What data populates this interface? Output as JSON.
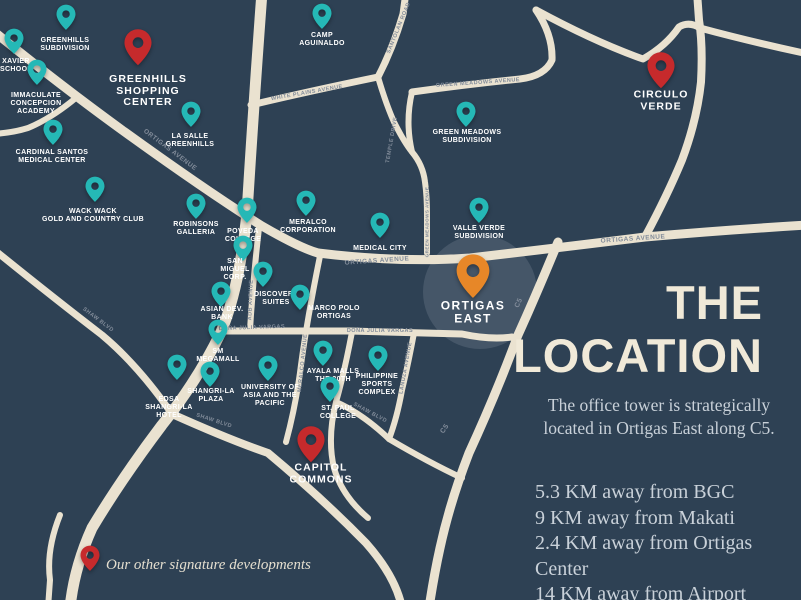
{
  "map": {
    "background_color": "#2e4154",
    "road_color": "#eae2d0",
    "pin_colors": {
      "teal": "#25b8b6",
      "red": "#c62a2c",
      "orange": "#e78728"
    },
    "highlight": {
      "x": 480,
      "y": 292,
      "r": 57
    },
    "pins": [
      {
        "id": "greenhills-subdivision",
        "type": "teal",
        "x": 66,
        "y": 20,
        "label": "GREENHILLS\nSUBDIVISION",
        "lx": 65,
        "ly": 45
      },
      {
        "id": "xavier-school",
        "type": "teal",
        "x": 14,
        "y": 44,
        "label": "XAVIER\nSCHOOL",
        "lx": 16,
        "ly": 66
      },
      {
        "id": "immaculate-concepcion-academy",
        "type": "teal",
        "x": 37,
        "y": 75,
        "label": "IMMACULATE\nCONCEPCION\nACADEMY",
        "lx": 36,
        "ly": 104
      },
      {
        "id": "cardinal-santos-medical-center",
        "type": "teal",
        "x": 53,
        "y": 135,
        "label": "CARDINAL SANTOS\nMEDICAL CENTER",
        "lx": 52,
        "ly": 157
      },
      {
        "id": "la-salle-greenhills",
        "type": "teal",
        "x": 191,
        "y": 117,
        "label": "LA SALLE\nGREENHILLS",
        "lx": 190,
        "ly": 141
      },
      {
        "id": "camp-aguinaldo",
        "type": "teal",
        "x": 322,
        "y": 19,
        "label": "CAMP\nAGUINALDO",
        "lx": 322,
        "ly": 40
      },
      {
        "id": "green-meadows-subdivision",
        "type": "teal",
        "x": 466,
        "y": 117,
        "label": "GREEN MEADOWS\nSUBDIVISION",
        "lx": 467,
        "ly": 137
      },
      {
        "id": "wack-wack-golf",
        "type": "teal",
        "x": 95,
        "y": 192,
        "label": "WACK WACK\nGOLD AND COUNTRY CLUB",
        "lx": 93,
        "ly": 216
      },
      {
        "id": "robinsons-galleria",
        "type": "teal",
        "x": 196,
        "y": 209,
        "label": "ROBINSONS\nGALLERIA",
        "lx": 196,
        "ly": 229
      },
      {
        "id": "poveda-college",
        "type": "teal",
        "x": 247,
        "y": 213,
        "label": "POVEDA\nCOLLEGE",
        "lx": 243,
        "ly": 236
      },
      {
        "id": "san-miguel-corp",
        "type": "teal",
        "x": 243,
        "y": 251,
        "label": "SAN\nMIGUEL\nCORP.",
        "lx": 235,
        "ly": 270
      },
      {
        "id": "discovery-suites",
        "type": "teal",
        "x": 263,
        "y": 277,
        "label": "DISCOVERY\nSUITES",
        "lx": 276,
        "ly": 299
      },
      {
        "id": "asian-dev-bank",
        "type": "teal",
        "x": 221,
        "y": 297,
        "label": "ASIAN DEV.\nBANK",
        "lx": 222,
        "ly": 314
      },
      {
        "id": "meralco-corporation",
        "type": "teal",
        "x": 306,
        "y": 206,
        "label": "MERALCO\nCORPORATION",
        "lx": 308,
        "ly": 227
      },
      {
        "id": "medical-city",
        "type": "teal",
        "x": 380,
        "y": 228,
        "label": "MEDICAL CITY",
        "lx": 380,
        "ly": 249
      },
      {
        "id": "valle-verde-subdivision",
        "type": "teal",
        "x": 479,
        "y": 213,
        "label": "VALLE VERDE\nSUBDIVISION",
        "lx": 479,
        "ly": 233
      },
      {
        "id": "marco-polo-ortigas",
        "type": "teal",
        "x": 300,
        "y": 300,
        "label": "MARCO POLO\nORTIGAS",
        "lx": 334,
        "ly": 313
      },
      {
        "id": "sm-megamall",
        "type": "teal",
        "x": 218,
        "y": 335,
        "label": "SM\nMEGAMALL",
        "lx": 218,
        "ly": 356
      },
      {
        "id": "shangri-la-plaza",
        "type": "teal",
        "x": 210,
        "y": 377,
        "label": "SHANGRI-LA\nPLAZA",
        "lx": 211,
        "ly": 396
      },
      {
        "id": "edsa-shangri-la-hotel",
        "type": "teal",
        "x": 177,
        "y": 370,
        "label": "EDSA\nSHANGRI-LA\nHOTEL",
        "lx": 169,
        "ly": 408
      },
      {
        "id": "university-asia-pacific",
        "type": "teal",
        "x": 268,
        "y": 371,
        "label": "UNIVERSITY OF\nASIA AND THE\nPACIFIC",
        "lx": 270,
        "ly": 396
      },
      {
        "id": "ayala-malls-30th",
        "type": "teal",
        "x": 323,
        "y": 356,
        "label": "AYALA MALLS\nTHE 30TH",
        "lx": 333,
        "ly": 376
      },
      {
        "id": "philippine-sports-complex",
        "type": "teal",
        "x": 378,
        "y": 361,
        "label": "PHILIPPINE\nSPORTS\nCOMPLEX",
        "lx": 377,
        "ly": 385
      },
      {
        "id": "st-paul-college",
        "type": "teal",
        "x": 330,
        "y": 392,
        "label": "ST. PAUL\nCOLLEGE",
        "lx": 338,
        "ly": 413
      },
      {
        "id": "greenhills-shopping-center",
        "type": "red",
        "x": 138,
        "y": 50,
        "label": "GREENHILLS\nSHOPPING\nCENTER",
        "lx": 148,
        "ly": 91
      },
      {
        "id": "circulo-verde",
        "type": "red",
        "x": 661,
        "y": 73,
        "label": "CIRCULO\nVERDE",
        "lx": 661,
        "ly": 101
      },
      {
        "id": "capitol-commons",
        "type": "red",
        "x": 311,
        "y": 447,
        "label": "CAPITOL\nCOMMONS",
        "lx": 321,
        "ly": 474
      },
      {
        "id": "ortigas-east",
        "type": "orange",
        "x": 473,
        "y": 279,
        "label": "ORTIGAS\nEAST",
        "lx": 473,
        "ly": 312
      },
      {
        "id": "legend-marker",
        "type": "red-small",
        "x": 90,
        "y": 561,
        "label": null,
        "lx": 0,
        "ly": 0
      }
    ],
    "road_labels": [
      {
        "id": "ortigas-avenue-west",
        "text": "ORTIGAS AVENUE",
        "x": 170,
        "y": 150,
        "rot": 37,
        "size": 6.5
      },
      {
        "id": "ortigas-avenue-mid",
        "text": "ORTIGAS AVENUE",
        "x": 377,
        "y": 261,
        "rot": -4,
        "size": 6.5
      },
      {
        "id": "ortigas-avenue-east",
        "text": "ORTIGAS AVENUE",
        "x": 633,
        "y": 239,
        "rot": -4,
        "size": 6.5
      },
      {
        "id": "dona-julia-vargas-west",
        "text": "DOÑA JULIA VARGAS",
        "x": 252,
        "y": 328,
        "rot": -2,
        "size": 5.5
      },
      {
        "id": "dona-julia-vargas-east",
        "text": "DOÑA JULIA VARGAS",
        "x": 380,
        "y": 331,
        "rot": 0,
        "size": 5.5
      },
      {
        "id": "white-plains-avenue",
        "text": "WHITE PLAINS AVENUE",
        "x": 307,
        "y": 93,
        "rot": -10,
        "size": 5.5
      },
      {
        "id": "green-meadows-avenue",
        "text": "GREEN MEADOWS AVENUE",
        "x": 478,
        "y": 83,
        "rot": -4,
        "size": 5.5
      },
      {
        "id": "green-meadows-avenue-vertical",
        "text": "GREEN MEADOWS AVENUE",
        "x": 427,
        "y": 222,
        "rot": -90,
        "size": 4.5
      },
      {
        "id": "temple-drive",
        "text": "TEMPLE DRIVE",
        "x": 392,
        "y": 140,
        "rot": -80,
        "size": 5.5
      },
      {
        "id": "santolan-road",
        "text": "SANTOLAN ROAD",
        "x": 399,
        "y": 28,
        "rot": -68,
        "size": 5.5
      },
      {
        "id": "adb-avenue",
        "text": "ADB AVENUE",
        "x": 251,
        "y": 300,
        "rot": -88,
        "size": 5.5
      },
      {
        "id": "meralco-avenue",
        "text": "MERALCO AVENUE",
        "x": 303,
        "y": 363,
        "rot": -84,
        "size": 5.5
      },
      {
        "id": "lanuza-avenue",
        "text": "LANUZA AVENUE",
        "x": 406,
        "y": 368,
        "rot": -80,
        "size": 5.5
      },
      {
        "id": "c5-upper",
        "text": "C5",
        "x": 519,
        "y": 303,
        "rot": -65,
        "size": 7
      },
      {
        "id": "c5-lower",
        "text": "C5",
        "x": 445,
        "y": 429,
        "rot": -55,
        "size": 7
      },
      {
        "id": "shaw-west",
        "text": "SHAW BLVD",
        "x": 98,
        "y": 320,
        "rot": 37,
        "size": 5.5
      },
      {
        "id": "shaw-east",
        "text": "SHAW BLVD",
        "x": 214,
        "y": 421,
        "rot": 18,
        "size": 5.5
      },
      {
        "id": "shaw-mid",
        "text": "SHAW BLVD",
        "x": 370,
        "y": 413,
        "rot": 28,
        "size": 5.5
      }
    ]
  },
  "panel": {
    "title_line1": "THE",
    "title_line2": "LOCATION",
    "subtitle_line1": "The office tower is strategically",
    "subtitle_line2": "located in Ortigas East along C5.",
    "distances": [
      "5.3 KM away from BGC",
      "9 KM away from Makati",
      "2.4 KM away from Ortigas Center",
      "14 KM away from Airport"
    ]
  },
  "legend": {
    "text": "Our other signature developments"
  }
}
